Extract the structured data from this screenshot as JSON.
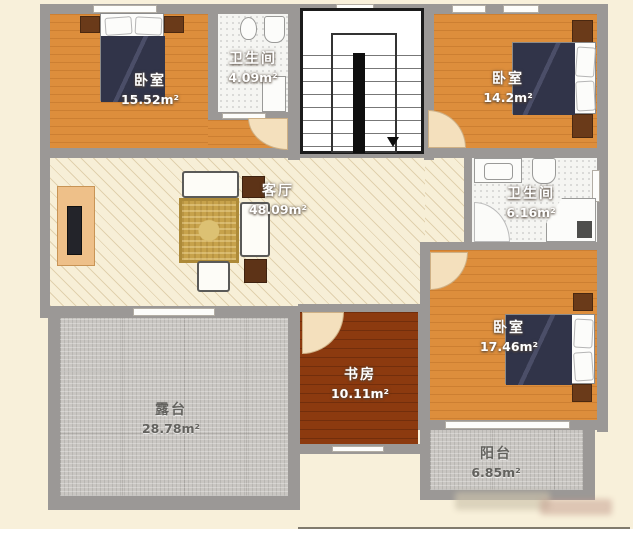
{
  "plan": {
    "rooms": [
      {
        "id": "bedroom-top-left",
        "name": "卧室",
        "area": "15.52m²"
      },
      {
        "id": "bathroom-top",
        "name": "卫生间",
        "area": "4.09m²"
      },
      {
        "id": "bedroom-top-right",
        "name": "卧室",
        "area": "14.2m²"
      },
      {
        "id": "living-room",
        "name": "客厅",
        "area": "48.09m²"
      },
      {
        "id": "bathroom-right",
        "name": "卫生间",
        "area": "6.16m²"
      },
      {
        "id": "bedroom-bottom-right",
        "name": "卧室",
        "area": "17.46m²"
      },
      {
        "id": "study",
        "name": "书房",
        "area": "10.11m²"
      },
      {
        "id": "terrace",
        "name": "露台",
        "area": "28.78m²"
      },
      {
        "id": "balcony",
        "name": "阳台",
        "area": "6.85m²"
      }
    ],
    "colors": {
      "background": "#f8f0da",
      "wall": "#9b9896",
      "bedroom_floor": "#dd8e3c",
      "living_floor": "#f7efd7",
      "bathroom_floor": "#f5f5f2",
      "terrace_floor": "#c9c6c2",
      "study_floor": "#8c3a0f",
      "bed": "#313449",
      "label_text": "#ffffff"
    }
  }
}
